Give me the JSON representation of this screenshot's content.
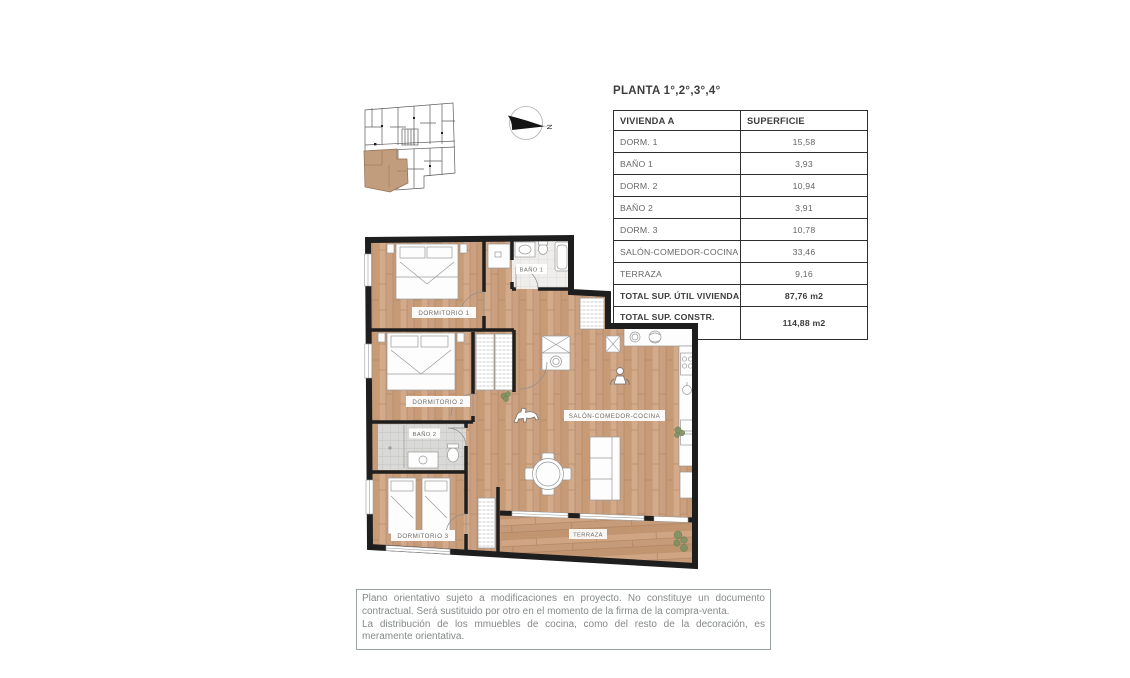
{
  "page": {
    "title": "PLANTA 1°,2°,3°,4°"
  },
  "table": {
    "header": {
      "col1": "VIVIENDA A",
      "col2": "SUPERFICIE"
    },
    "rows": [
      {
        "label": "DORM. 1",
        "value": "15,58"
      },
      {
        "label": "BAÑO 1",
        "value": "3,93"
      },
      {
        "label": "DORM. 2",
        "value": "10,94"
      },
      {
        "label": "BAÑO 2",
        "value": "3,91"
      },
      {
        "label": "DORM. 3",
        "value": "10,78"
      },
      {
        "label": "SALÓN-COMEDOR-COCINA",
        "value": "33,46"
      },
      {
        "label": "TERRAZA",
        "value": "9,16"
      }
    ],
    "totals": [
      {
        "label": "TOTAL SUP. ÚTIL VIVIENDA",
        "value": "87,76 m2"
      },
      {
        "label_line1": "TOTAL SUP. CONSTR.",
        "label_line2": "VIV + PP +ZC",
        "value": "114,88 m2"
      }
    ]
  },
  "floorplan": {
    "labels": {
      "dorm1": "DORMITORIO 1",
      "bano1": "BAÑO 1",
      "dorm2": "DORMITORIO 2",
      "bano2": "BAÑO 2",
      "dorm3": "DORMITORIO 3",
      "salon": "SALÓN-COMEDOR-COCINA",
      "terraza": "TERRAZA"
    },
    "compass": {
      "label": "N"
    }
  },
  "colors": {
    "wall": "#1e1e1e",
    "wood_floor": "#cba081",
    "keyplan_highlight": "#c29d7d",
    "bath1_tile": "#efeeec",
    "bath2_tile": "#d9d9d7",
    "plant_green": "#7d9060",
    "label_text": "#6e6e6e",
    "table_border": "#2e2e2e",
    "disclaimer_text": "#85898a"
  },
  "disclaimer": {
    "line1": "Plano orientativo sujeto a modificaciones en proyecto. No constituye un documento contractual. Será sustituido por otro en el momento de la firma de la compra-venta.",
    "line2": "La distribución de los mmuebles de cocina, como del resto de la decoración, es meramente orientativa."
  }
}
